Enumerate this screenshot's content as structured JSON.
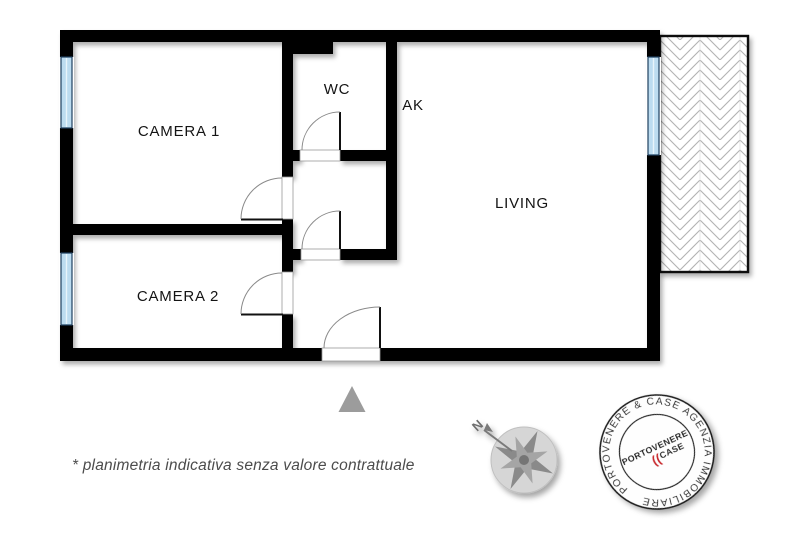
{
  "labels": {
    "camera1": "CAMERA 1",
    "camera2": "CAMERA 2",
    "wc": "WC",
    "ak": "AK",
    "living": "LIVING"
  },
  "disclaimer": "* planimetria indicativa senza valore contrattuale",
  "compass": {
    "north": "N"
  },
  "stamp": {
    "ring": "PORTOVENERE & CASE AGENZIA IMMOBILIARE",
    "center_top": "PORTOVENERE",
    "center_bottom": "CASE",
    "mark": "(("
  },
  "colors": {
    "wall": "#000000",
    "window_fill": "#bcdcf0",
    "window_border": "#1e3f5f",
    "balcony_hatch": "#b3b3b3",
    "door_arc": "#8a8a8a",
    "compass_gray": "#8a8a8a",
    "triangle_gray": "#9c9c9c",
    "stamp_red": "#c9252c",
    "label_text": "#141414",
    "disclaimer_text": "#4c4c4c"
  }
}
